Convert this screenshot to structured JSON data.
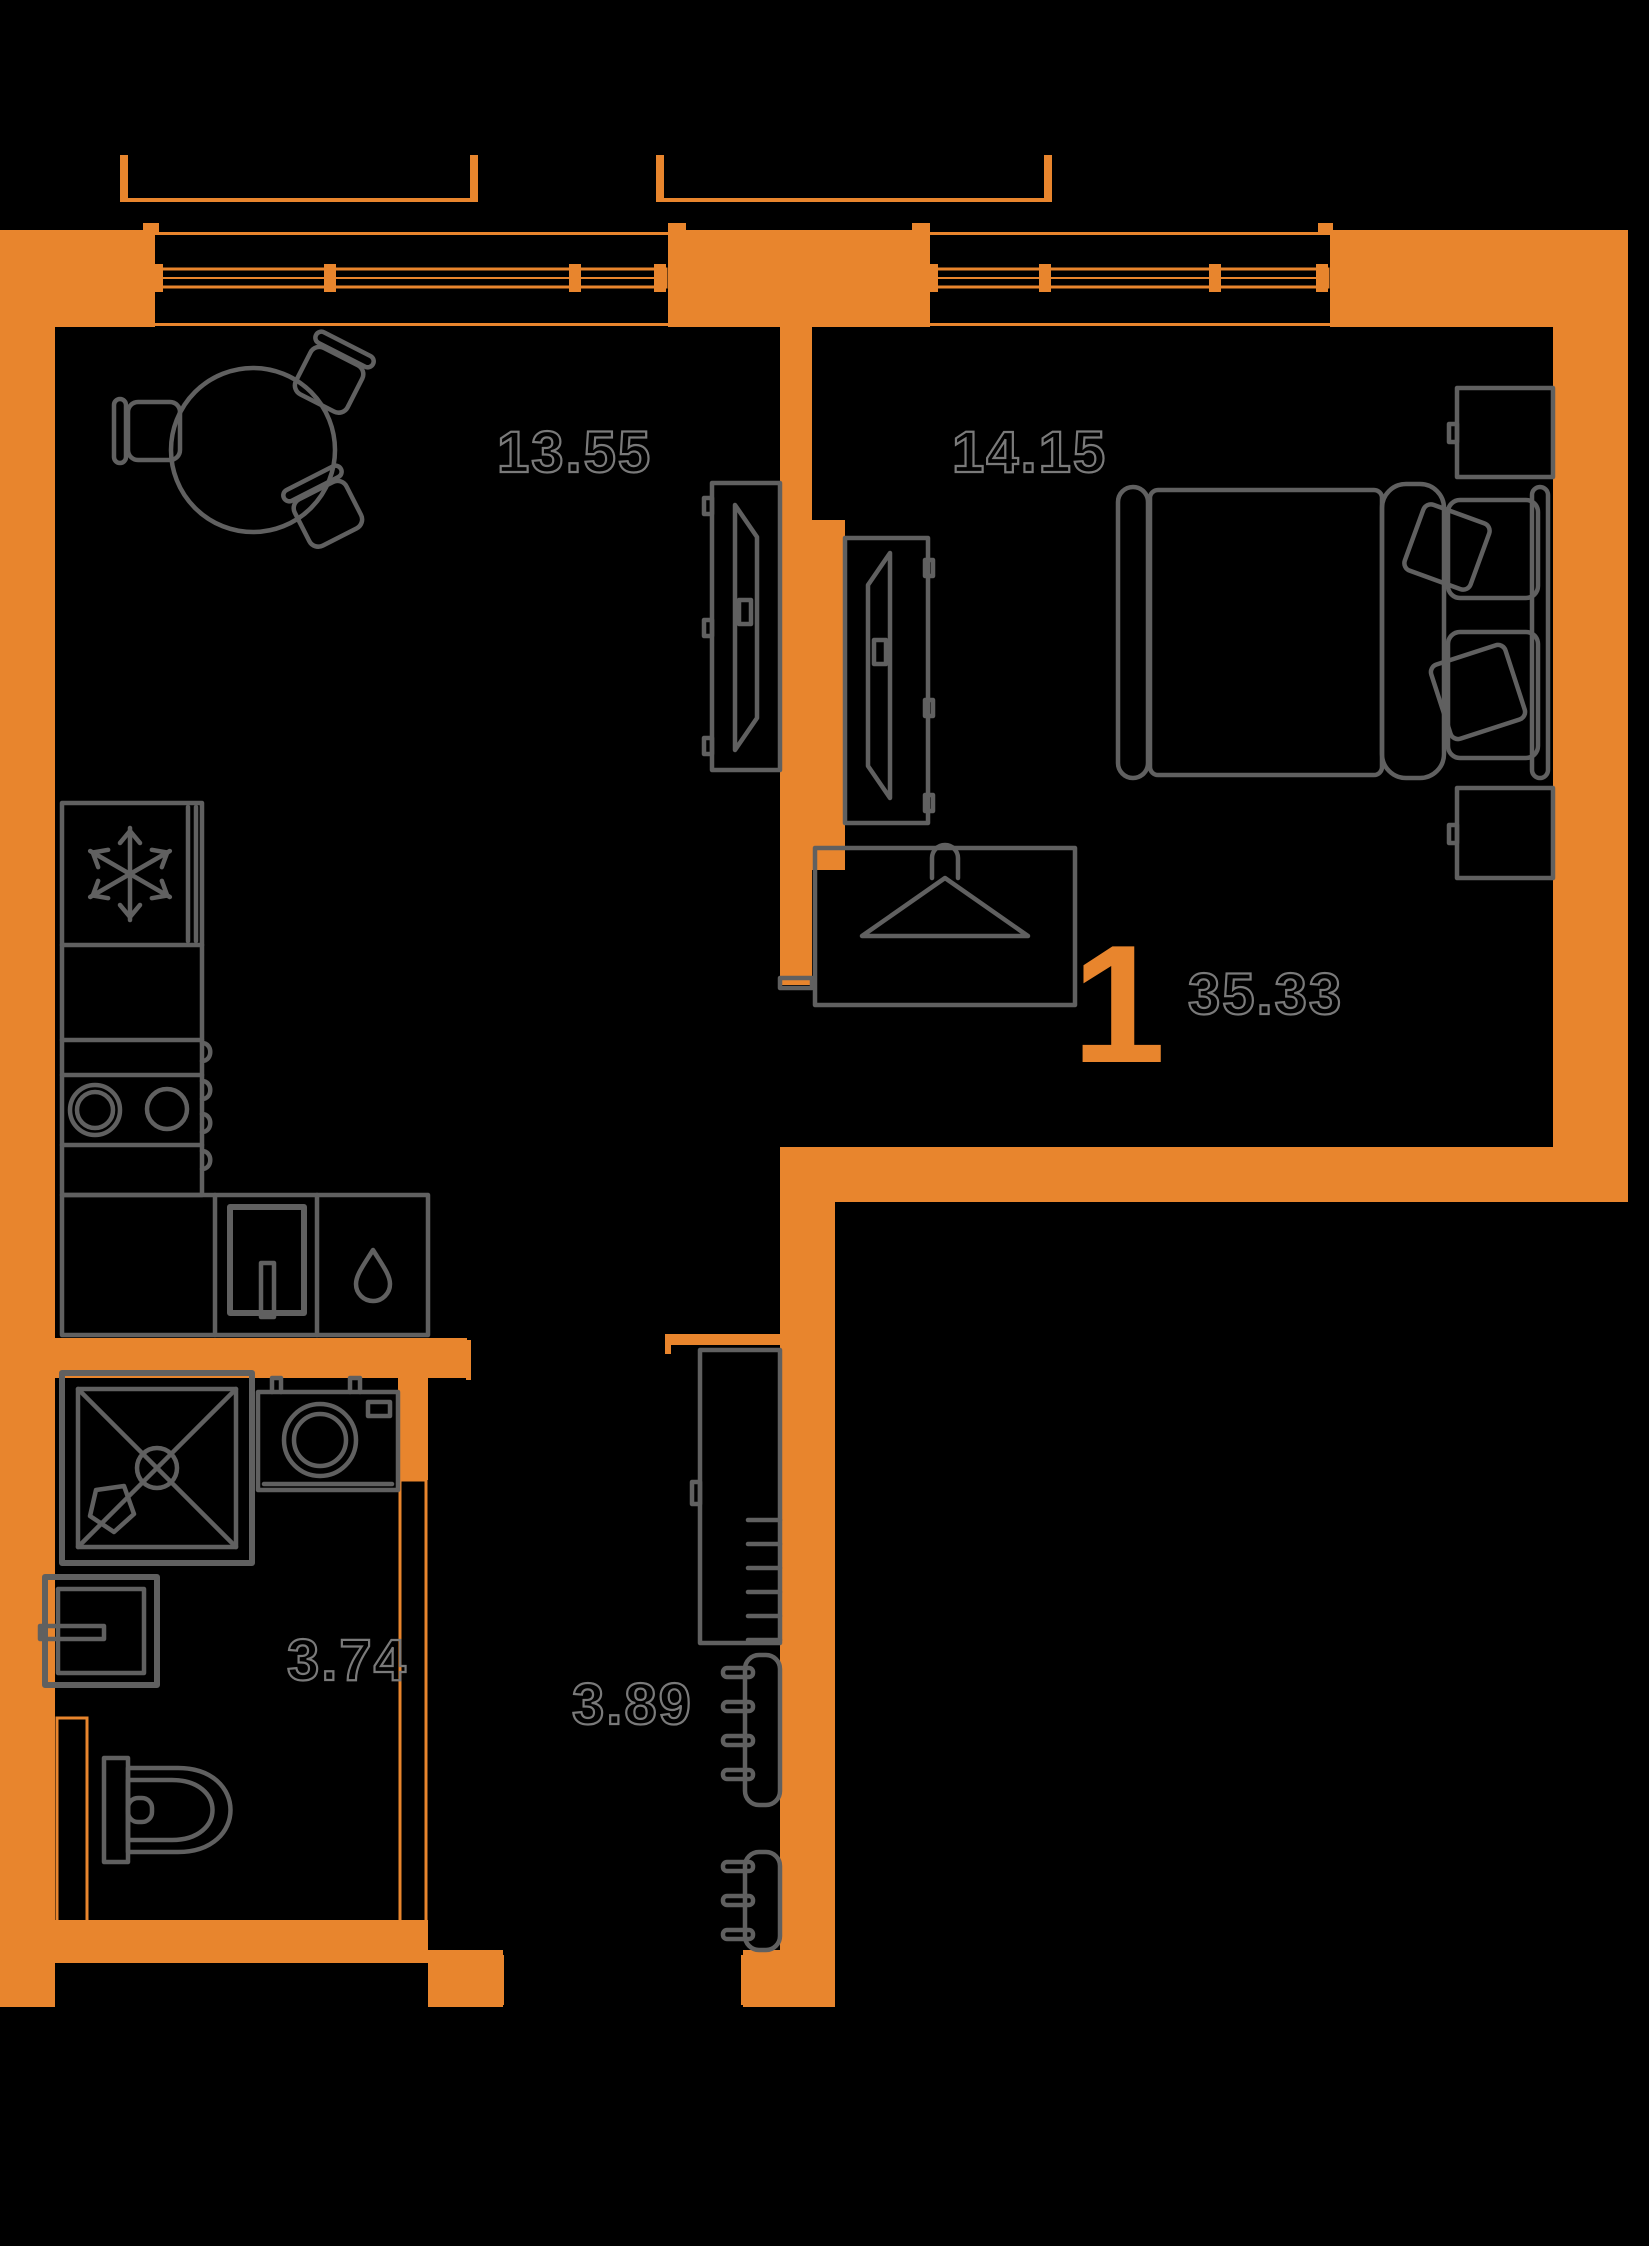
{
  "plan": {
    "layout_number": "1",
    "total_area": "35.33",
    "rooms": [
      {
        "name": "kitchen-living-room",
        "area": "13.55"
      },
      {
        "name": "bedroom",
        "area": "14.15"
      },
      {
        "name": "bathroom",
        "area": "3.74"
      },
      {
        "name": "hallway",
        "area": "3.89"
      }
    ],
    "colors": {
      "background": "#000000",
      "wall": "#e8852d",
      "furniture_line": "#606060",
      "area_label": "#7a7a7a"
    },
    "icons": {
      "fridge": "snowflake-icon",
      "wardrobe": "hanger-icon",
      "kitchen_sink": "drop-icon"
    }
  }
}
